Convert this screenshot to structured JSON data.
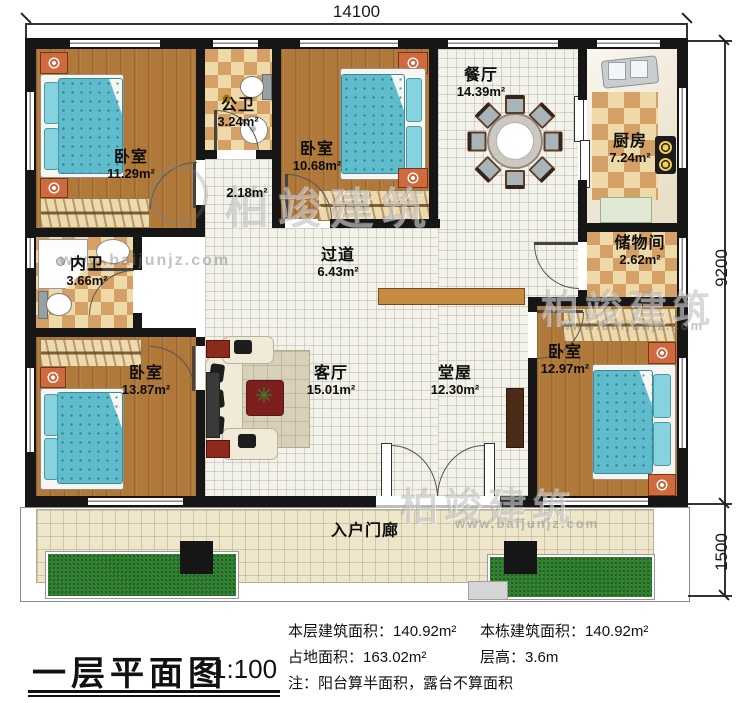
{
  "plan": {
    "dimensions": {
      "width_top": "14100",
      "height_main": "9200",
      "height_porch": "1500"
    },
    "rooms": {
      "bedroom_top_left": {
        "name": "卧室",
        "area": "11.29m²"
      },
      "public_bathroom": {
        "name": "公卫",
        "area": "3.24m²"
      },
      "hallway_nook": {
        "area": "2.18m²"
      },
      "bedroom_top_middle": {
        "name": "卧室",
        "area": "10.68m²"
      },
      "dining_room": {
        "name": "餐厅",
        "area": "14.39m²"
      },
      "kitchen": {
        "name": "厨房",
        "area": "7.24m²"
      },
      "storage_room": {
        "name": "储物间",
        "area": "2.62m²"
      },
      "master_bathroom": {
        "name": "内卫",
        "area": "3.66m²"
      },
      "corridor": {
        "name": "过道",
        "area": "6.43m²"
      },
      "living_room": {
        "name": "客厅",
        "area": "15.01m²"
      },
      "main_hall": {
        "name": "堂屋",
        "area": "12.30m²"
      },
      "bedroom_bottom_left": {
        "name": "卧室",
        "area": "13.87m²"
      },
      "bedroom_bottom_right": {
        "name": "卧室",
        "area": "12.97m²"
      },
      "entry_porch": {
        "name": "入户门廊"
      }
    },
    "title_block": {
      "title": "一层平面图",
      "scale": "1:100"
    },
    "stats": {
      "floor_area": {
        "label": "本层建筑面积：",
        "value": "140.92m²"
      },
      "building_area": {
        "label": "本栋建筑面积：",
        "value": "140.92m²"
      },
      "land_area": {
        "label": "占地面积：",
        "value": "163.02m²"
      },
      "storey_height": {
        "label": "层高：",
        "value": "3.6m"
      },
      "note": "注：阳台算半面积，露台不算面积"
    },
    "watermark": {
      "brand": "柏竣建筑",
      "url": "www.baijunjz.com"
    }
  }
}
